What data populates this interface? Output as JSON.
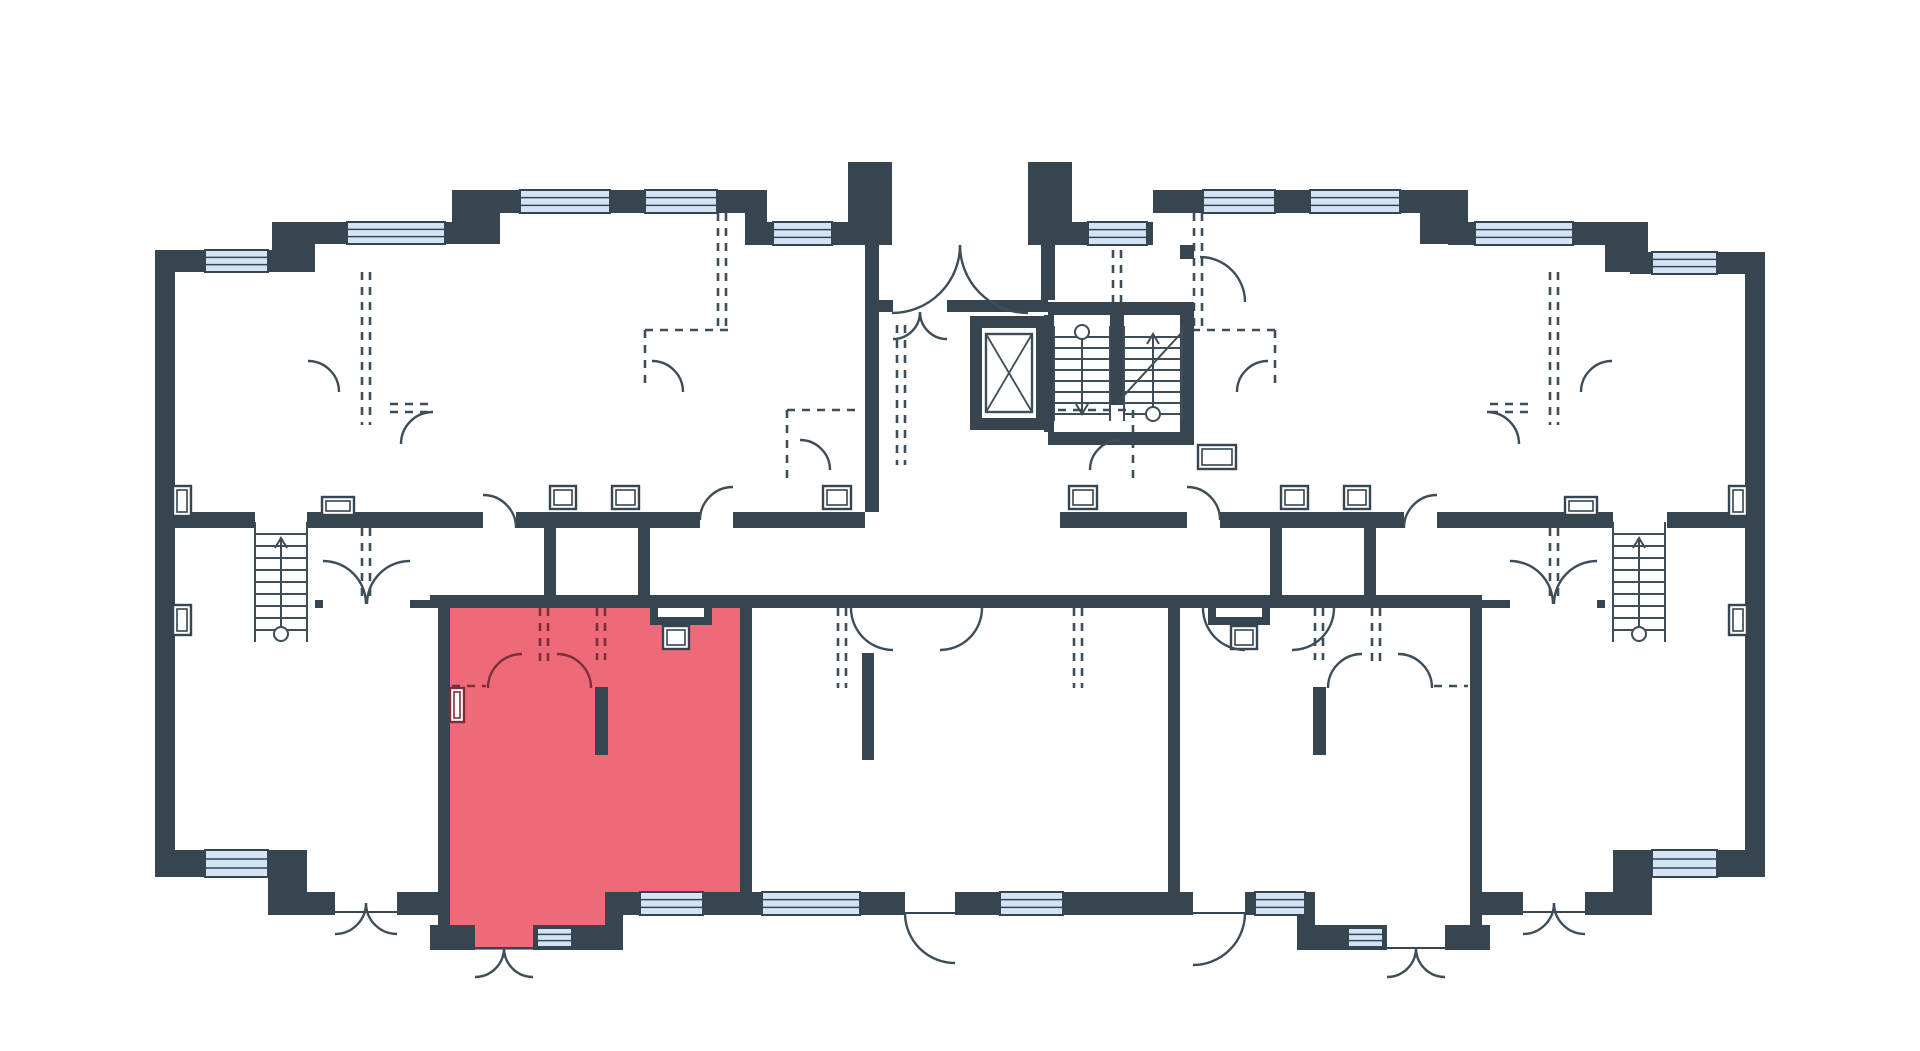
{
  "canvas": {
    "width": 1920,
    "height": 1051
  },
  "colors": {
    "background": "#ffffff",
    "wall": "#36454f",
    "line": "#3d4e59",
    "window_fill": "#d2e4f6",
    "highlight_fill": "#ef6a78",
    "highlight_line": "#7c2e3d"
  },
  "highlighted_unit": {
    "polygon": "438,595 752,595 752,915 617,915 617,950 438,950",
    "notch_rect": [
      650,
      595,
      62,
      30
    ]
  },
  "walls": [
    [
      155,
      250,
      20,
      627
    ],
    [
      155,
      250,
      135,
      22
    ],
    [
      272,
      222,
      43,
      50
    ],
    [
      290,
      222,
      182,
      22
    ],
    [
      452,
      190,
      48,
      54
    ],
    [
      472,
      190,
      295,
      23
    ],
    [
      745,
      190,
      22,
      55
    ],
    [
      767,
      222,
      81,
      23
    ],
    [
      848,
      162,
      44,
      83
    ],
    [
      1028,
      162,
      44,
      83
    ],
    [
      1072,
      222,
      81,
      23
    ],
    [
      1153,
      190,
      295,
      23
    ],
    [
      1420,
      190,
      48,
      54
    ],
    [
      1448,
      222,
      182,
      23
    ],
    [
      1605,
      222,
      43,
      50
    ],
    [
      1630,
      252,
      135,
      22
    ],
    [
      1745,
      252,
      20,
      625
    ],
    [
      865,
      245,
      14,
      267
    ],
    [
      879,
      300,
      14,
      12
    ],
    [
      947,
      300,
      101,
      12
    ],
    [
      1041,
      245,
      14,
      55
    ],
    [
      1180,
      245,
      14,
      14
    ],
    [
      1048,
      302,
      140,
      13
    ],
    [
      1180,
      302,
      14,
      143
    ],
    [
      1048,
      432,
      142,
      13
    ],
    [
      1044,
      315,
      10,
      117
    ],
    [
      1110,
      313,
      14,
      92
    ],
    [
      175,
      512,
      80,
      16
    ],
    [
      307,
      512,
      176,
      16
    ],
    [
      516,
      512,
      184,
      16
    ],
    [
      733,
      512,
      132,
      16
    ],
    [
      1060,
      512,
      127,
      16
    ],
    [
      1220,
      512,
      184,
      16
    ],
    [
      1437,
      512,
      176,
      16
    ],
    [
      1667,
      512,
      78,
      16
    ],
    [
      544,
      528,
      12,
      70
    ],
    [
      638,
      528,
      12,
      70
    ],
    [
      1270,
      528,
      12,
      70
    ],
    [
      1364,
      528,
      12,
      70
    ],
    [
      430,
      595,
      322,
      13
    ],
    [
      650,
      608,
      8,
      17
    ],
    [
      704,
      608,
      8,
      17
    ],
    [
      650,
      617,
      62,
      8
    ],
    [
      438,
      595,
      12,
      355
    ],
    [
      740,
      595,
      12,
      310
    ],
    [
      595,
      687,
      13,
      68
    ],
    [
      315,
      600,
      8,
      8
    ],
    [
      410,
      600,
      28,
      8
    ],
    [
      1597,
      600,
      8,
      8
    ],
    [
      1482,
      600,
      28,
      8
    ],
    [
      752,
      595,
      128,
      13
    ],
    [
      880,
      595,
      288,
      13
    ],
    [
      1168,
      595,
      12,
      310
    ],
    [
      1180,
      595,
      302,
      13
    ],
    [
      1208,
      608,
      8,
      17
    ],
    [
      1262,
      608,
      8,
      17
    ],
    [
      1208,
      617,
      62,
      8
    ],
    [
      1470,
      595,
      12,
      355
    ],
    [
      1313,
      687,
      13,
      68
    ],
    [
      862,
      653,
      12,
      107
    ],
    [
      155,
      850,
      152,
      27
    ],
    [
      268,
      850,
      39,
      65
    ],
    [
      283,
      892,
      52,
      23
    ],
    [
      397,
      892,
      41,
      23
    ],
    [
      430,
      925,
      45,
      25
    ],
    [
      533,
      925,
      90,
      25
    ],
    [
      605,
      892,
      18,
      58
    ],
    [
      617,
      892,
      135,
      23
    ],
    [
      752,
      892,
      153,
      23
    ],
    [
      955,
      892,
      225,
      23
    ],
    [
      1297,
      892,
      18,
      58
    ],
    [
      1297,
      925,
      90,
      25
    ],
    [
      1445,
      925,
      45,
      25
    ],
    [
      1180,
      892,
      13,
      23
    ],
    [
      1245,
      892,
      70,
      23
    ],
    [
      1482,
      892,
      41,
      23
    ],
    [
      1585,
      892,
      52,
      23
    ],
    [
      1613,
      850,
      39,
      65
    ],
    [
      1613,
      850,
      152,
      27
    ]
  ],
  "windows": [
    [
      205,
      250,
      63,
      22
    ],
    [
      347,
      222,
      98,
      22
    ],
    [
      520,
      190,
      90,
      23
    ],
    [
      645,
      190,
      72,
      23
    ],
    [
      773,
      222,
      59,
      23
    ],
    [
      1088,
      222,
      59,
      23
    ],
    [
      1203,
      190,
      72,
      23
    ],
    [
      1310,
      190,
      90,
      23
    ],
    [
      1475,
      222,
      98,
      23
    ],
    [
      1652,
      252,
      65,
      22
    ],
    [
      205,
      850,
      63,
      27
    ],
    [
      537,
      928,
      35,
      19
    ],
    [
      640,
      892,
      63,
      23
    ],
    [
      762,
      892,
      98,
      23
    ],
    [
      1000,
      892,
      63,
      23
    ],
    [
      1255,
      892,
      50,
      23
    ],
    [
      1348,
      928,
      35,
      19
    ],
    [
      1652,
      850,
      65,
      27
    ]
  ],
  "side_vents": [
    [
      173,
      486,
      18,
      30
    ],
    [
      173,
      605,
      18,
      30
    ],
    [
      1729,
      486,
      18,
      30
    ],
    [
      1729,
      605,
      18,
      30
    ]
  ],
  "shaft_vents": [
    [
      322,
      497,
      32,
      18
    ],
    [
      550,
      486,
      26,
      23
    ],
    [
      612,
      486,
      27,
      23
    ],
    [
      823,
      486,
      28,
      23
    ],
    [
      1069,
      486,
      28,
      23
    ],
    [
      1281,
      486,
      27,
      23
    ],
    [
      1344,
      486,
      26,
      23
    ],
    [
      1565,
      497,
      32,
      18
    ],
    [
      1198,
      445,
      38,
      24
    ],
    [
      663,
      626,
      26,
      23
    ],
    [
      1231,
      626,
      26,
      23
    ]
  ],
  "highlight_vent": [
    450,
    688,
    14,
    34
  ],
  "dashes_dark": [
    [
      362,
      272,
      362,
      425
    ],
    [
      370,
      272,
      370,
      425
    ],
    [
      718,
      213,
      718,
      330
    ],
    [
      726,
      213,
      726,
      330
    ],
    [
      645,
      330,
      728,
      330
    ],
    [
      645,
      330,
      645,
      390
    ],
    [
      787,
      410,
      862,
      410
    ],
    [
      787,
      410,
      787,
      478
    ],
    [
      362,
      528,
      362,
      600
    ],
    [
      370,
      528,
      370,
      600
    ],
    [
      838,
      608,
      838,
      688
    ],
    [
      846,
      608,
      846,
      688
    ],
    [
      1113,
      250,
      1113,
      302
    ],
    [
      1121,
      250,
      1121,
      302
    ],
    [
      1550,
      528,
      1550,
      600
    ],
    [
      1558,
      528,
      1558,
      600
    ],
    [
      1550,
      272,
      1550,
      425
    ],
    [
      1558,
      272,
      1558,
      425
    ],
    [
      1194,
      213,
      1194,
      330
    ],
    [
      1202,
      213,
      1202,
      330
    ],
    [
      1192,
      330,
      1275,
      330
    ],
    [
      1275,
      330,
      1275,
      390
    ],
    [
      1058,
      410,
      1133,
      410
    ],
    [
      1133,
      410,
      1133,
      478
    ],
    [
      1074,
      608,
      1074,
      688
    ],
    [
      1082,
      608,
      1082,
      688
    ],
    [
      897,
      325,
      897,
      465
    ],
    [
      905,
      325,
      905,
      465
    ],
    [
      390,
      404,
      430,
      404
    ],
    [
      390,
      412,
      430,
      412
    ],
    [
      1490,
      404,
      1530,
      404
    ],
    [
      1490,
      412,
      1530,
      412
    ],
    [
      1372,
      608,
      1372,
      668
    ],
    [
      1380,
      608,
      1380,
      668
    ],
    [
      1315,
      608,
      1315,
      660
    ],
    [
      1323,
      608,
      1323,
      660
    ],
    [
      1434,
      686,
      1468,
      686
    ]
  ],
  "dashes_highlight": [
    [
      540,
      608,
      540,
      668
    ],
    [
      548,
      608,
      548,
      668
    ],
    [
      597,
      608,
      597,
      660
    ],
    [
      605,
      608,
      605,
      660
    ],
    [
      452,
      686,
      486,
      686
    ]
  ],
  "doors_dark": [
    "M960,245 A68,68 0 0 1 892,313",
    "M960,245 A68,68 0 0 0 1028,313",
    "M920,312 A27,27 0 0 1 893,339",
    "M920,312 A27,27 0 0 0 947,339",
    "M1200,257 A45,45 0 0 1 1245,302",
    "M516,528 A33,33 0 0 0 483,495",
    "M1404,528 A33,33 0 0 1 1437,495",
    "M366,604 A43,43 0 0 0 323,561",
    "M367,604 A43,43 0 0 1 410,561",
    "M1553,604 A43,43 0 0 0 1510,561",
    "M1554,604 A43,43 0 0 1 1597,561",
    "M366,903 A31,31 0 0 1 335,934",
    "M366,903 A31,31 0 0 0 397,934",
    "M504,948 A29,29 0 0 1 475,977",
    "M504,948 A29,29 0 0 0 533,977",
    "M905,913 A50,50 0 0 0 955,963",
    "M1245,913 A52,52 0 0 1 1193,965",
    "M1416,948 A29,29 0 0 1 1387,977",
    "M1416,948 A29,29 0 0 0 1445,977",
    "M1554,903 A31,31 0 0 1 1523,934",
    "M1554,903 A31,31 0 0 0 1585,934",
    "M1432,688 A34,34 0 0 0 1398,654",
    "M1328,688 A34,34 0 0 1 1362,654",
    "M401,444 A32,32 0 0 1 433,412",
    "M339,392 A31,31 0 0 0 308,361",
    "M683,392 A31,31 0 0 0 652,361",
    "M830,470 A30,30 0 0 0 800,440",
    "M1519,444 A32,32 0 0 0 1487,412",
    "M1581,392 A31,31 0 0 1 1612,361",
    "M1237,392 A31,31 0 0 1 1268,361",
    "M1090,470 A30,30 0 0 1 1120,440",
    "M700,520 A33,33 0 0 1 733,487",
    "M1220,520 A33,33 0 0 0 1187,487",
    "M851,608 A42,42 0 0 0 893,650",
    "M982,608 A42,42 0 0 1 940,650",
    "M1203,608 A42,42 0 0 0 1245,650",
    "M1334,608 A42,42 0 0 1 1292,650"
  ],
  "doors_highlight": [
    "M488,688 A34,34 0 0 1 522,654",
    "M591,688 A34,34 0 0 0 557,654"
  ],
  "thresholds": [
    [
      475,
      948,
      533,
      948
    ],
    [
      1387,
      948,
      1445,
      948
    ],
    [
      335,
      912,
      397,
      912
    ],
    [
      1523,
      912,
      1585,
      912
    ],
    [
      905,
      913,
      955,
      913
    ],
    [
      1193,
      913,
      1245,
      913
    ]
  ],
  "stairs_side": [
    {
      "x1": 255,
      "x2": 307,
      "y1": 522,
      "y2": 642,
      "step": 12,
      "arrow": {
        "x": 281,
        "y1": 636,
        "y2": 538,
        "head": "up"
      },
      "circle": [
        281,
        634
      ]
    },
    {
      "x1": 1613,
      "x2": 1665,
      "y1": 522,
      "y2": 642,
      "step": 12,
      "arrow": {
        "x": 1639,
        "y1": 636,
        "y2": 538,
        "head": "up"
      },
      "circle": [
        1639,
        634
      ]
    }
  ],
  "stairs_core": {
    "left": {
      "x1": 1054,
      "x2": 1110,
      "y1": 326,
      "y2": 421,
      "step": 11,
      "arrow": {
        "x": 1082,
        "y1": 334,
        "y2": 414,
        "head": "down"
      },
      "circle": [
        1082,
        332
      ]
    },
    "right": {
      "x1": 1124,
      "x2": 1182,
      "y1": 326,
      "y2": 421,
      "step": 11,
      "arrow": {
        "x": 1153,
        "y1": 414,
        "y2": 334,
        "head": "up"
      },
      "circle": [
        1153,
        414
      ]
    },
    "diagonal": [
      1118,
      402,
      1184,
      330
    ]
  },
  "elevator": {
    "frame": [
      970,
      316,
      78,
      114
    ],
    "thickness": 12,
    "box": [
      986,
      334,
      46,
      78
    ]
  }
}
